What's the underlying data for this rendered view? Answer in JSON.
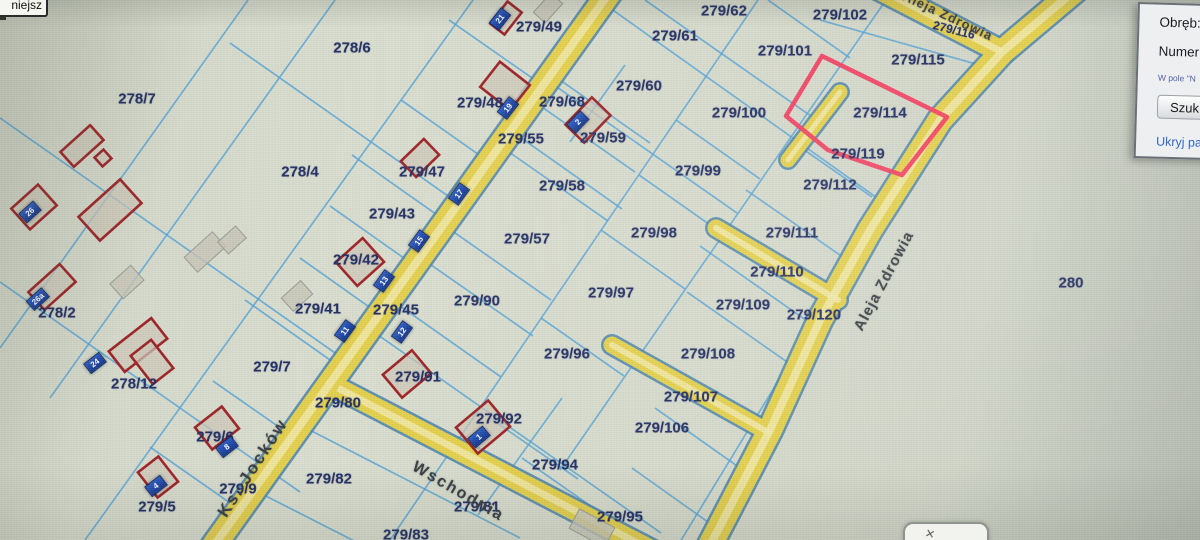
{
  "ui": {
    "zoom_button_label": "niejsz",
    "search_panel": {
      "obreb_label": "Obręb:",
      "numer_label": "Numer n",
      "hint_text": "W pole \"N",
      "search_button": "Szuk",
      "hide_link": "Ukryj pa"
    },
    "popup_close_glyph": "✕"
  },
  "map": {
    "colors": {
      "road_fill": "#e5d14e",
      "road_casing": "#4d86ad",
      "boundary_line": "#55a4d8",
      "building_outline": "#9e2428",
      "badge_blue": "#1d47a8",
      "highlight_pink": "#f43f60",
      "label_navy": "#233066"
    },
    "highlight_parcel": {
      "label": "279/114",
      "points": "822,56 947,117 902,175 828,150 786,116"
    },
    "parcel_labels": [
      {
        "t": "278/6",
        "x": 352,
        "y": 48
      },
      {
        "t": "278/7",
        "x": 137,
        "y": 99
      },
      {
        "t": "278/4",
        "x": 300,
        "y": 172
      },
      {
        "t": "278/2",
        "x": 57,
        "y": 313
      },
      {
        "t": "278/12",
        "x": 134,
        "y": 384
      },
      {
        "t": "279/49",
        "x": 539,
        "y": 27
      },
      {
        "t": "279/48",
        "x": 480,
        "y": 103
      },
      {
        "t": "279/68",
        "x": 562,
        "y": 102
      },
      {
        "t": "279/55",
        "x": 521,
        "y": 139
      },
      {
        "t": "279/59",
        "x": 603,
        "y": 138
      },
      {
        "t": "279/60",
        "x": 639,
        "y": 86
      },
      {
        "t": "279/61",
        "x": 675,
        "y": 36
      },
      {
        "t": "279/62",
        "x": 724,
        "y": 11
      },
      {
        "t": "279/102",
        "x": 840,
        "y": 15
      },
      {
        "t": "279/101",
        "x": 785,
        "y": 51
      },
      {
        "t": "279/115",
        "x": 918,
        "y": 60
      },
      {
        "t": "279/116",
        "x": 954,
        "y": 30,
        "s": 12,
        "r": 14
      },
      {
        "t": "279/100",
        "x": 739,
        "y": 113
      },
      {
        "t": "279/114",
        "x": 880,
        "y": 113
      },
      {
        "t": "279/119",
        "x": 858,
        "y": 154
      },
      {
        "t": "279/112",
        "x": 830,
        "y": 185
      },
      {
        "t": "279/111",
        "x": 792,
        "y": 233
      },
      {
        "t": "279/110",
        "x": 777,
        "y": 272
      },
      {
        "t": "279/99",
        "x": 698,
        "y": 171
      },
      {
        "t": "279/98",
        "x": 654,
        "y": 233
      },
      {
        "t": "279/97",
        "x": 611,
        "y": 293
      },
      {
        "t": "279/96",
        "x": 567,
        "y": 354
      },
      {
        "t": "279/57",
        "x": 527,
        "y": 239
      },
      {
        "t": "279/58",
        "x": 562,
        "y": 186
      },
      {
        "t": "279/47",
        "x": 422,
        "y": 172
      },
      {
        "t": "279/43",
        "x": 392,
        "y": 214
      },
      {
        "t": "279/42",
        "x": 356,
        "y": 260
      },
      {
        "t": "279/45",
        "x": 396,
        "y": 310
      },
      {
        "t": "279/41",
        "x": 318,
        "y": 309
      },
      {
        "t": "279/90",
        "x": 477,
        "y": 301
      },
      {
        "t": "279/91",
        "x": 418,
        "y": 377
      },
      {
        "t": "279/92",
        "x": 499,
        "y": 419
      },
      {
        "t": "279/7",
        "x": 272,
        "y": 367
      },
      {
        "t": "279/80",
        "x": 338,
        "y": 403
      },
      {
        "t": "279/82",
        "x": 329,
        "y": 479
      },
      {
        "t": "279/81",
        "x": 477,
        "y": 507
      },
      {
        "t": "279/83",
        "x": 406,
        "y": 535
      },
      {
        "t": "279/6",
        "x": 215,
        "y": 437
      },
      {
        "t": "279/9",
        "x": 238,
        "y": 489
      },
      {
        "t": "279/5",
        "x": 157,
        "y": 507
      },
      {
        "t": "279/94",
        "x": 555,
        "y": 465
      },
      {
        "t": "279/95",
        "x": 620,
        "y": 517
      },
      {
        "t": "279/106",
        "x": 662,
        "y": 428
      },
      {
        "t": "279/107",
        "x": 691,
        "y": 397
      },
      {
        "t": "279/108",
        "x": 708,
        "y": 354
      },
      {
        "t": "279/109",
        "x": 743,
        "y": 305
      },
      {
        "t": "279/120",
        "x": 814,
        "y": 315
      },
      {
        "t": "280",
        "x": 1071,
        "y": 283
      }
    ],
    "road_labels": [
      {
        "t": "Ks. Jocków",
        "x": 253,
        "y": 468,
        "r": -57,
        "s": 17,
        "ls": 2
      },
      {
        "t": "Wschodnia",
        "x": 458,
        "y": 492,
        "r": 30,
        "s": 16,
        "ls": 2
      },
      {
        "t": "Aleja Zdrowia",
        "x": 884,
        "y": 281,
        "r": -62,
        "s": 15,
        "ls": 1
      },
      {
        "t": "Aleja Zdrowia",
        "x": 948,
        "y": 16,
        "r": 25,
        "s": 13,
        "ls": 1
      }
    ],
    "address_badges": [
      {
        "n": "21",
        "x": 500,
        "y": 19,
        "r": -52
      },
      {
        "n": "19",
        "x": 508,
        "y": 108,
        "r": -52
      },
      {
        "n": "2",
        "x": 578,
        "y": 122,
        "r": -46
      },
      {
        "n": "17",
        "x": 459,
        "y": 194,
        "r": -54
      },
      {
        "n": "15",
        "x": 419,
        "y": 241,
        "r": -54
      },
      {
        "n": "13",
        "x": 384,
        "y": 281,
        "r": -54
      },
      {
        "n": "11",
        "x": 345,
        "y": 331,
        "r": -54
      },
      {
        "n": "12",
        "x": 402,
        "y": 332,
        "r": -54
      },
      {
        "n": "1",
        "x": 479,
        "y": 437,
        "r": -40
      },
      {
        "n": "24",
        "x": 95,
        "y": 363,
        "r": -38
      },
      {
        "n": "26",
        "x": 30,
        "y": 212,
        "r": -42
      },
      {
        "n": "26a",
        "x": 38,
        "y": 299,
        "r": -42
      },
      {
        "n": "8",
        "x": 227,
        "y": 447,
        "r": -38
      },
      {
        "n": "4",
        "x": 156,
        "y": 486,
        "r": -38
      }
    ],
    "roads": [
      {
        "pts": [
          [
            617,
            -18
          ],
          [
            205,
            558
          ]
        ],
        "w": 24
      },
      {
        "pts": [
          [
            338,
            388
          ],
          [
            682,
            566
          ]
        ],
        "w": 20
      },
      {
        "pts": [
          [
            872,
            -15
          ],
          [
            1002,
            52
          ]
        ],
        "w": 22
      },
      {
        "pts": [
          [
            1085,
            -18
          ],
          [
            1002,
            52
          ]
        ],
        "w": 24
      },
      {
        "pts": [
          [
            1002,
            52
          ],
          [
            940,
            120
          ],
          [
            870,
            230
          ],
          [
            820,
            320
          ],
          [
            770,
            430
          ],
          [
            705,
            555
          ]
        ],
        "w": 24
      },
      {
        "pts": [
          [
            838,
            300
          ],
          [
            716,
            228
          ]
        ],
        "w": 17,
        "cap": "round"
      },
      {
        "pts": [
          [
            768,
            432
          ],
          [
            612,
            345
          ]
        ],
        "w": 17,
        "cap": "round"
      },
      {
        "pts": [
          [
            840,
            92
          ],
          [
            788,
            160
          ]
        ],
        "w": 15,
        "cap": "round"
      }
    ],
    "boundary_lines": [
      [
        248,
        0,
        0,
        348
      ],
      [
        335,
        0,
        50,
        398
      ],
      [
        230,
        43,
        458,
        203
      ],
      [
        0,
        118,
        348,
        362
      ],
      [
        0,
        282,
        300,
        492
      ],
      [
        473,
        0,
        85,
        540
      ],
      [
        449,
        20,
        535,
        80
      ],
      [
        401,
        100,
        492,
        164
      ],
      [
        352,
        155,
        450,
        224
      ],
      [
        330,
        206,
        418,
        268
      ],
      [
        300,
        258,
        382,
        316
      ],
      [
        245,
        300,
        340,
        367
      ],
      [
        213,
        381,
        289,
        434
      ],
      [
        150,
        447,
        233,
        505
      ],
      [
        610,
        8,
        880,
        200
      ],
      [
        560,
        80,
        650,
        143
      ],
      [
        554,
        85,
        737,
        213
      ],
      [
        539,
        105,
        635,
        172
      ],
      [
        517,
        135,
        622,
        209
      ],
      [
        506,
        150,
        608,
        221
      ],
      [
        448,
        228,
        551,
        300
      ],
      [
        393,
        301,
        501,
        377
      ],
      [
        424,
        260,
        533,
        336
      ],
      [
        368,
        328,
        661,
        533
      ],
      [
        562,
        398,
        478,
        515
      ],
      [
        625,
        65,
        570,
        142
      ],
      [
        758,
        0,
        390,
        540
      ],
      [
        886,
        0,
        560,
        470
      ],
      [
        965,
        75,
        672,
        555
      ],
      [
        676,
        120,
        760,
        179
      ],
      [
        639,
        175,
        723,
        234
      ],
      [
        601,
        230,
        685,
        289
      ],
      [
        541,
        318,
        624,
        376
      ],
      [
        490,
        418,
        578,
        479
      ],
      [
        522,
        458,
        648,
        546
      ],
      [
        645,
        0,
        818,
        121
      ],
      [
        768,
        0,
        850,
        58
      ],
      [
        820,
        20,
        990,
        68
      ],
      [
        790,
        140,
        872,
        197
      ],
      [
        746,
        190,
        850,
        262
      ],
      [
        700,
        246,
        820,
        330
      ],
      [
        687,
        292,
        790,
        364
      ],
      [
        655,
        408,
        740,
        468
      ],
      [
        632,
        468,
        715,
        527
      ],
      [
        300,
        425,
        520,
        538
      ],
      [
        258,
        492,
        372,
        550
      ]
    ],
    "buildings_red": [
      {
        "x": 82,
        "y": 146,
        "w": 40,
        "h": 20,
        "r": -42
      },
      {
        "x": 103,
        "y": 158,
        "w": 12,
        "h": 12,
        "r": -42
      },
      {
        "x": 110,
        "y": 210,
        "w": 56,
        "h": 32,
        "r": -42
      },
      {
        "x": 34,
        "y": 207,
        "w": 36,
        "h": 28,
        "r": -42
      },
      {
        "x": 52,
        "y": 287,
        "w": 42,
        "h": 24,
        "r": -42
      },
      {
        "x": 138,
        "y": 345,
        "w": 54,
        "h": 26,
        "r": -38
      },
      {
        "x": 152,
        "y": 362,
        "w": 26,
        "h": 36,
        "r": -38
      },
      {
        "x": 217,
        "y": 428,
        "w": 34,
        "h": 28,
        "r": -38
      },
      {
        "x": 158,
        "y": 477,
        "w": 26,
        "h": 32,
        "r": -38
      },
      {
        "x": 506,
        "y": 18,
        "w": 28,
        "h": 18,
        "r": -52
      },
      {
        "x": 505,
        "y": 86,
        "w": 32,
        "h": 38,
        "r": -52
      },
      {
        "x": 588,
        "y": 120,
        "w": 38,
        "h": 26,
        "r": -46
      },
      {
        "x": 420,
        "y": 158,
        "w": 32,
        "h": 22,
        "r": -44
      },
      {
        "x": 360,
        "y": 262,
        "w": 36,
        "h": 32,
        "r": -42
      },
      {
        "x": 407,
        "y": 374,
        "w": 38,
        "h": 30,
        "r": -40
      },
      {
        "x": 483,
        "y": 427,
        "w": 42,
        "h": 34,
        "r": -40
      }
    ],
    "buildings_gray": [
      {
        "x": 548,
        "y": 8,
        "w": 26,
        "h": 16,
        "r": -48
      },
      {
        "x": 205,
        "y": 252,
        "w": 38,
        "h": 20,
        "r": -42
      },
      {
        "x": 232,
        "y": 240,
        "w": 24,
        "h": 16,
        "r": -42
      },
      {
        "x": 297,
        "y": 296,
        "w": 26,
        "h": 18,
        "r": -42
      },
      {
        "x": 127,
        "y": 282,
        "w": 28,
        "h": 20,
        "r": -42
      },
      {
        "x": 592,
        "y": 528,
        "w": 40,
        "h": 22,
        "r": 28
      }
    ]
  }
}
